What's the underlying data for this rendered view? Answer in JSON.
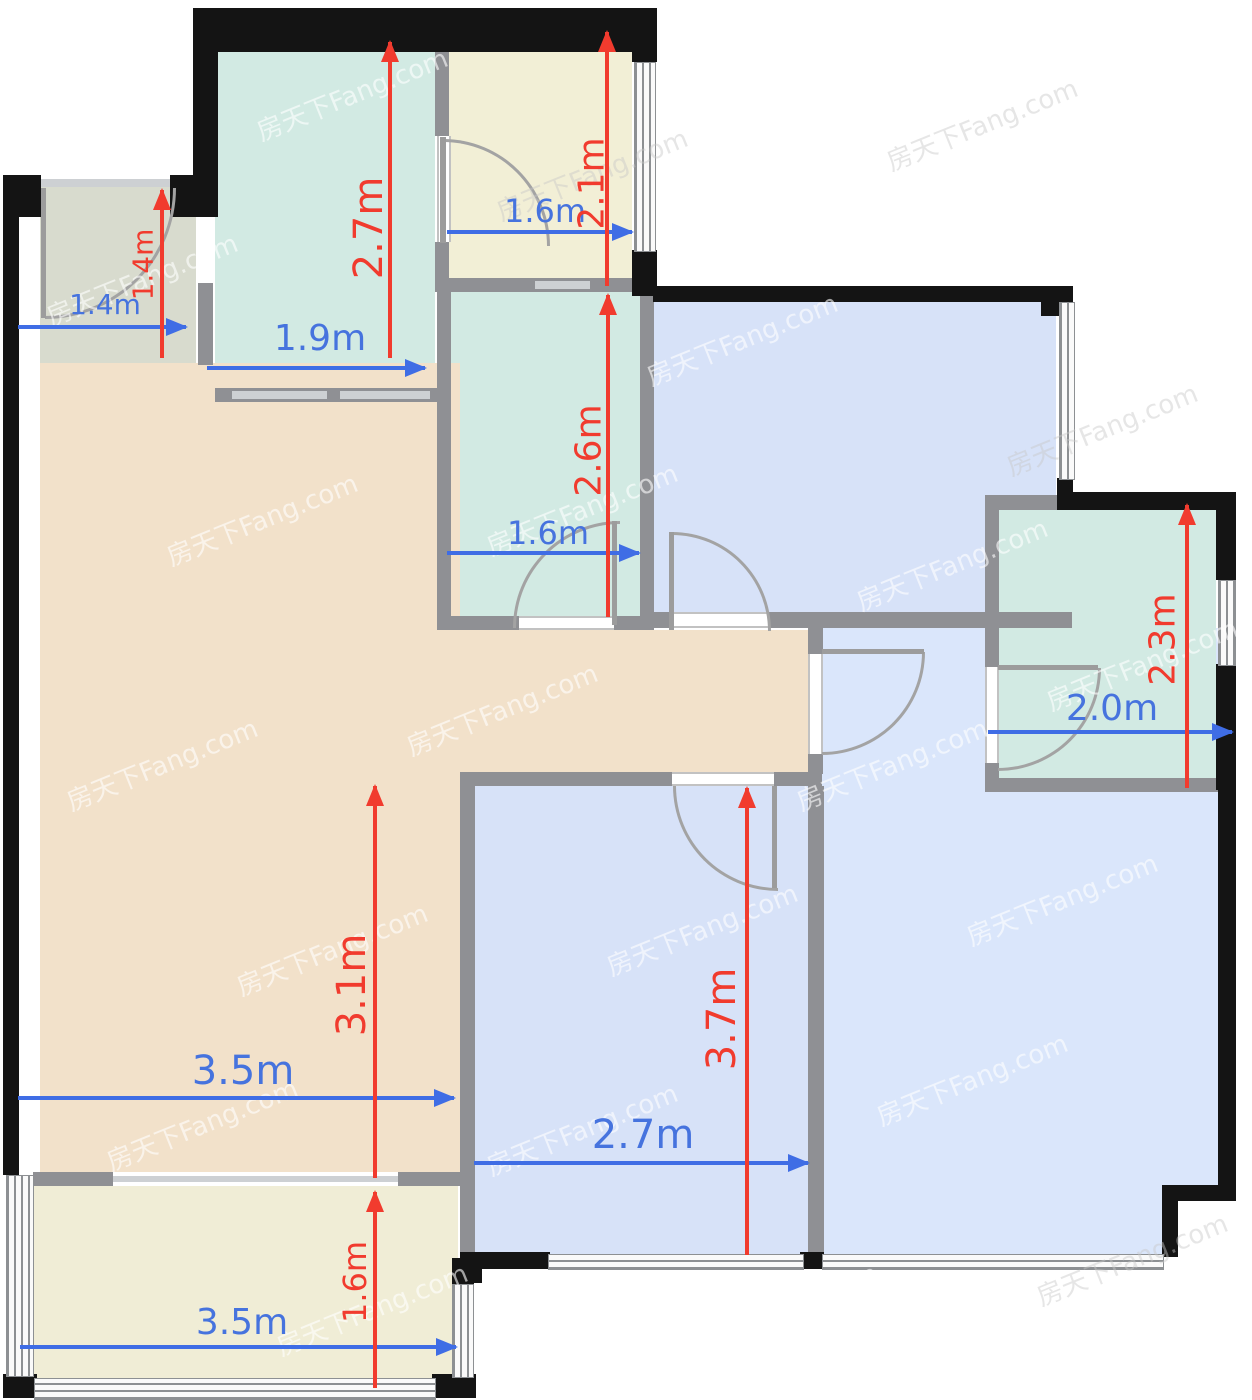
{
  "title": "apartment-floor-plan",
  "watermark": {
    "text": "房天下Fang.com"
  },
  "colors": {
    "entry": "#d8dbce",
    "teal": "#d2eae3",
    "cream": "#f2efd6",
    "cream_balcony": "#f0edd6",
    "blue": "#d7e2f8",
    "blue_light": "#dae6fb",
    "tan": "#f2e1ca",
    "wall_black": "#141414",
    "wall_gray": "#8f9094",
    "dim_blue": "#3f6de5",
    "dim_red": "#f13b2e"
  },
  "rooms": [
    {
      "id": "entry-hall",
      "fill": "#d8dbce",
      "width": "1.4m",
      "depth": "1.4m"
    },
    {
      "id": "kitchen-top",
      "fill": "#d2eae3",
      "width": "1.9m",
      "depth": "2.7m"
    },
    {
      "id": "room-top-cream",
      "fill": "#f2efd6",
      "width": "1.6m",
      "depth": "2.1m"
    },
    {
      "id": "bath-middle",
      "fill": "#d2eae3",
      "width": "1.6m",
      "depth": "2.6m"
    },
    {
      "id": "bedroom-top-right",
      "fill": "#d7e2f8"
    },
    {
      "id": "bath-right",
      "fill": "#d2eae3",
      "width": "2.0m",
      "depth": "2.3m"
    },
    {
      "id": "living-dining",
      "fill": "#f2e1ca",
      "width": "3.5m",
      "depth": "3.1m"
    },
    {
      "id": "bedroom-bottom",
      "fill": "#d7e2f8",
      "width": "2.7m",
      "depth": "3.7m"
    },
    {
      "id": "bedroom-right",
      "fill": "#dae6fb"
    },
    {
      "id": "balcony-bottom",
      "fill": "#f0edd6",
      "width": "3.5m",
      "depth": "1.6m"
    }
  ],
  "dimensions": {
    "entry_width": {
      "label": "1.4m",
      "color": "blue",
      "orientation": "horizontal"
    },
    "entry_depth": {
      "label": "1.4m",
      "color": "red",
      "orientation": "vertical"
    },
    "kitchen_width": {
      "label": "1.9m",
      "color": "blue",
      "orientation": "horizontal"
    },
    "kitchen_depth": {
      "label": "2.7m",
      "color": "red",
      "orientation": "vertical"
    },
    "top_room_width": {
      "label": "1.6m",
      "color": "blue",
      "orientation": "horizontal"
    },
    "top_room_depth": {
      "label": "2.1m",
      "color": "red",
      "orientation": "vertical"
    },
    "mid_bath_width": {
      "label": "1.6m",
      "color": "blue",
      "orientation": "horizontal"
    },
    "mid_bath_depth": {
      "label": "2.6m",
      "color": "red",
      "orientation": "vertical"
    },
    "right_bath_width": {
      "label": "2.0m",
      "color": "blue",
      "orientation": "horizontal"
    },
    "right_bath_depth": {
      "label": "2.3m",
      "color": "red",
      "orientation": "vertical"
    },
    "living_width": {
      "label": "3.5m",
      "color": "blue",
      "orientation": "horizontal"
    },
    "living_depth": {
      "label": "3.1m",
      "color": "red",
      "orientation": "vertical"
    },
    "bottom_bed_width": {
      "label": "2.7m",
      "color": "blue",
      "orientation": "horizontal"
    },
    "bottom_bed_depth": {
      "label": "3.7m",
      "color": "red",
      "orientation": "vertical"
    },
    "balcony_width": {
      "label": "3.5m",
      "color": "blue",
      "orientation": "horizontal"
    },
    "balcony_depth": {
      "label": "1.6m",
      "color": "red",
      "orientation": "vertical"
    }
  }
}
